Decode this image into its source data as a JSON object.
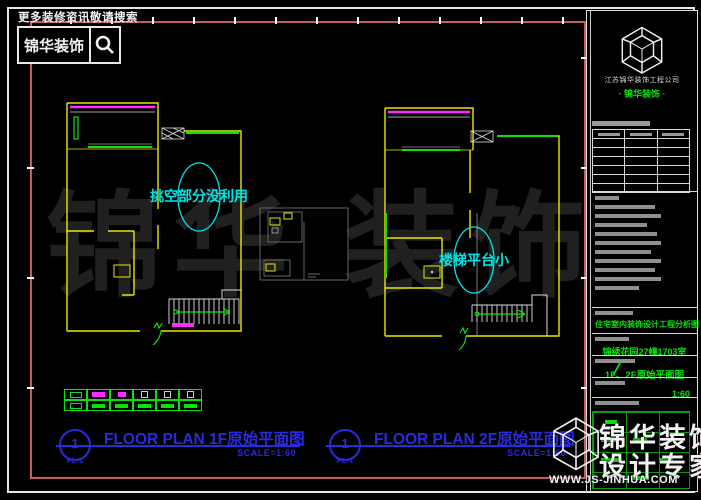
{
  "topbar": {
    "promo": "更多装修资讯敬请搜索",
    "brand": "锦华装饰"
  },
  "plan1": {
    "annotation": "挑空部分没利用",
    "title_num": "1",
    "title_sheet": "PL-1",
    "title_name": "FLOOR PLAN 1F原始平面图",
    "title_scale": "SCALE=1:60"
  },
  "plan2": {
    "annotation": "楼梯平台小",
    "title_num": "1",
    "title_sheet": "PL-1",
    "title_name": "FLOOR PLAN 2F原始平面图",
    "title_scale": "SCALE=1:60"
  },
  "titleblock": {
    "company": "江苏锦华装饰工程公司",
    "tagline": "· 锦华装饰 ·",
    "project": "住宅室内装饰设计工程分析图",
    "address": "锦绣花园27幢1703室",
    "drawing_name": "1F、2F原始平面图",
    "scale": "1:60"
  },
  "watermark": {
    "canvas": "锦华 装饰",
    "brand1": "锦华装饰",
    "brand2": "设计专家",
    "url": "WWW.JS-JINHUA.COM"
  },
  "legend": {
    "rows": [
      [
        "g-sym",
        "m-rect",
        "m-small",
        "w-sym",
        "w-sym",
        "w-sym"
      ],
      [
        "g-sym",
        "g-bar",
        "g-bar",
        "g-bar",
        "g-bar",
        "g-bar"
      ]
    ]
  },
  "decor": {
    "top_ticks": 13,
    "side_ticks": 4,
    "notes_bars": [
      24,
      60,
      66,
      52,
      62,
      66,
      56,
      66,
      60,
      66,
      44
    ],
    "table_rows": 7,
    "table_cols": 3,
    "sign_bars": [
      [
        8,
        26,
        16
      ],
      [
        40,
        26,
        14
      ],
      [
        8,
        46,
        18
      ],
      [
        66,
        46,
        14
      ],
      [
        40,
        64,
        16
      ],
      [
        12,
        8,
        12
      ]
    ]
  },
  "colors": {
    "wall": "#e8e800",
    "magenta": "#ff2bff",
    "green": "#0ae00a",
    "cyan": "#00e6e6",
    "blue": "#2b2bdc",
    "red": "#c25e5e",
    "wm": "#202020"
  }
}
